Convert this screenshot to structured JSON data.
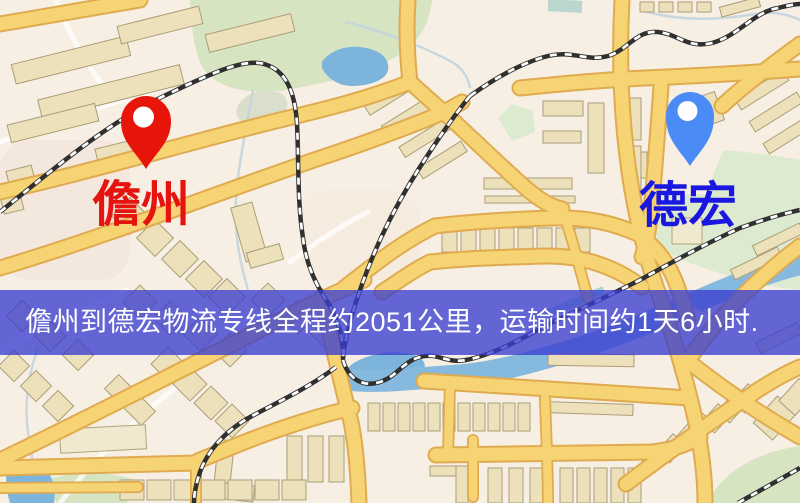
{
  "banner": {
    "text": "儋州到德宏物流专线全程约2051公里，运输时间约1天6小时.",
    "background": "rgba(58,62,208,0.78)",
    "text_color": "#ffffff"
  },
  "markers": {
    "origin": {
      "label": "儋州",
      "label_color": "#e51410",
      "pin_color": "#e8150a"
    },
    "destination": {
      "label": "德宏",
      "label_color": "#1a17e0",
      "pin_color": "#4b8bf5"
    }
  },
  "route": {
    "origin": "儋州",
    "destination": "德宏",
    "distance_text": "约2051公里",
    "duration_text": "约1天6小时"
  },
  "map_colors": {
    "background": "#f7efe3",
    "road_fill": "#f6d473",
    "road_casing": "#e0ab50",
    "water": "#85b9de",
    "park_green": "#d6e4c2",
    "railway": "#303030",
    "building": "#ece1bb"
  }
}
